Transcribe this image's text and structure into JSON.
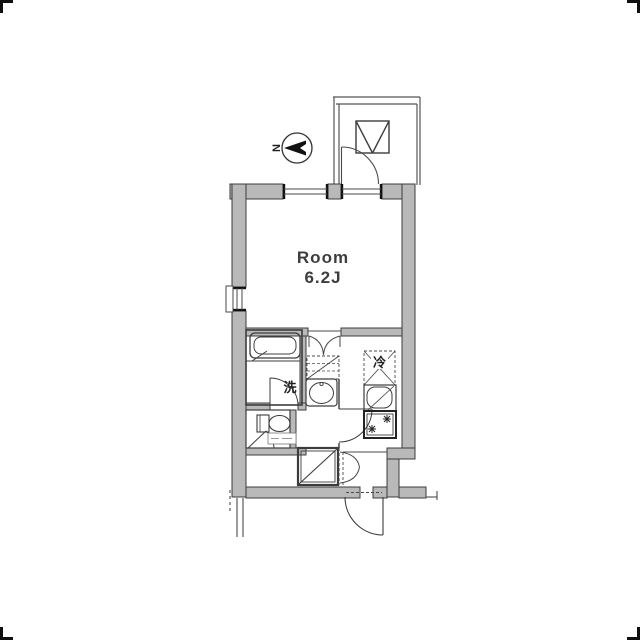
{
  "plan": {
    "type": "apartment-floor-plan",
    "room": {
      "label_line1": "Room",
      "label_line2": "6.2J",
      "size_tatami": "6.2J"
    },
    "labels": {
      "washing_machine_space": "洗",
      "refrigerator_space": "冷",
      "compass_north": "N",
      "toilet_tag": ""
    },
    "icons": [
      "north-compass-icon",
      "escape-hatch-icon",
      "bathtub-icon",
      "toilet-icon",
      "washbasin-icon",
      "kitchen-sink-icon",
      "stove-burner-icon",
      "refrigerator-space-icon",
      "washer-space-icon",
      "shoe-cabinet-icon",
      "door-swing-icon",
      "double-door-swing-icon",
      "window-icon"
    ],
    "colors": {
      "background": "#ffffff",
      "wall_fill": "#b9b9b9",
      "wall_edge": "#3c3c3c",
      "thin_line": "#4a4a4a",
      "text": "#3d3d3d"
    }
  }
}
